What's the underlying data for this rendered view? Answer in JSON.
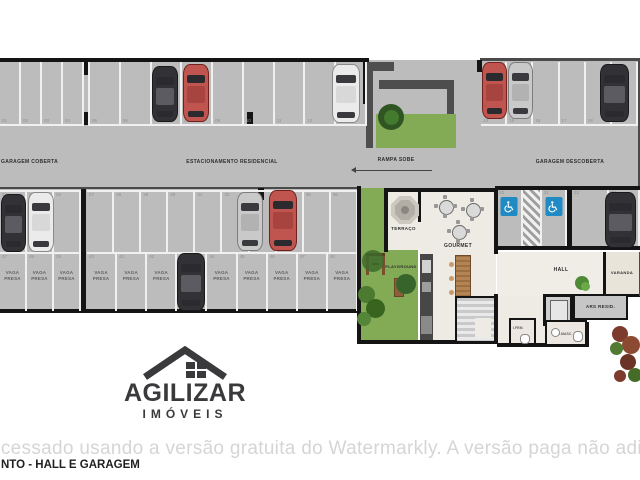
{
  "plan": {
    "areas": {
      "garagem_coberta": "GARAGEM COBERTA",
      "estacionamento_residencial": "ESTACIONAMENTO RESIDENCIAL",
      "rampa_sobe": "RAMPA SOBE",
      "garagem_descoberta": "GARAGEM DESCOBERTA",
      "terraco": "TERRAÇO",
      "gourmet": "GOURMET",
      "playground": "PLAYGROUND",
      "hall": "HALL",
      "varanda": "VARANDA",
      "ars_resid": "ARS RESID.",
      "banheiro_1": "I.FEM.",
      "banheiro_2": "I.MASC."
    },
    "vaga_presa": {
      "line1": "VAGA",
      "line2": "PRESA"
    },
    "spaces": {
      "top_a": [
        "01",
        "02",
        "03",
        "04"
      ],
      "top_b": [
        "05",
        "06",
        "07",
        "08",
        "09",
        "10",
        "11",
        "12",
        "13"
      ],
      "top_c": [
        "14",
        "15",
        "16",
        "17",
        "18",
        "19"
      ],
      "acc": [
        "20",
        "21",
        "22",
        "23"
      ],
      "mid_top_a": [
        "24",
        "25",
        "26"
      ],
      "mid_top_b": [
        "27",
        "28",
        "29",
        "30",
        "31",
        "32",
        "33",
        "34",
        "35",
        "36"
      ],
      "mid_bot_a": [
        "37",
        "38",
        "39"
      ],
      "mid_bot_b": [
        "40",
        "41",
        "42",
        "43",
        "44",
        "45",
        "46",
        "47",
        "48"
      ]
    },
    "colors": {
      "asphalt": "#bcbcbc",
      "accessible_blue": "#1f8ac4",
      "lawn_green": "#83aa55",
      "floor_beige": "#eeebe4"
    }
  },
  "logo": {
    "brand": "AGILIZAR",
    "segment": "IMÓVEIS"
  },
  "watermark": {
    "text": "ocessado usando a versão gratuita do Watermarkly. A versão paga não adiciona esta mar"
  },
  "footer": {
    "text": "NTO - HALL E GARAGEM"
  }
}
